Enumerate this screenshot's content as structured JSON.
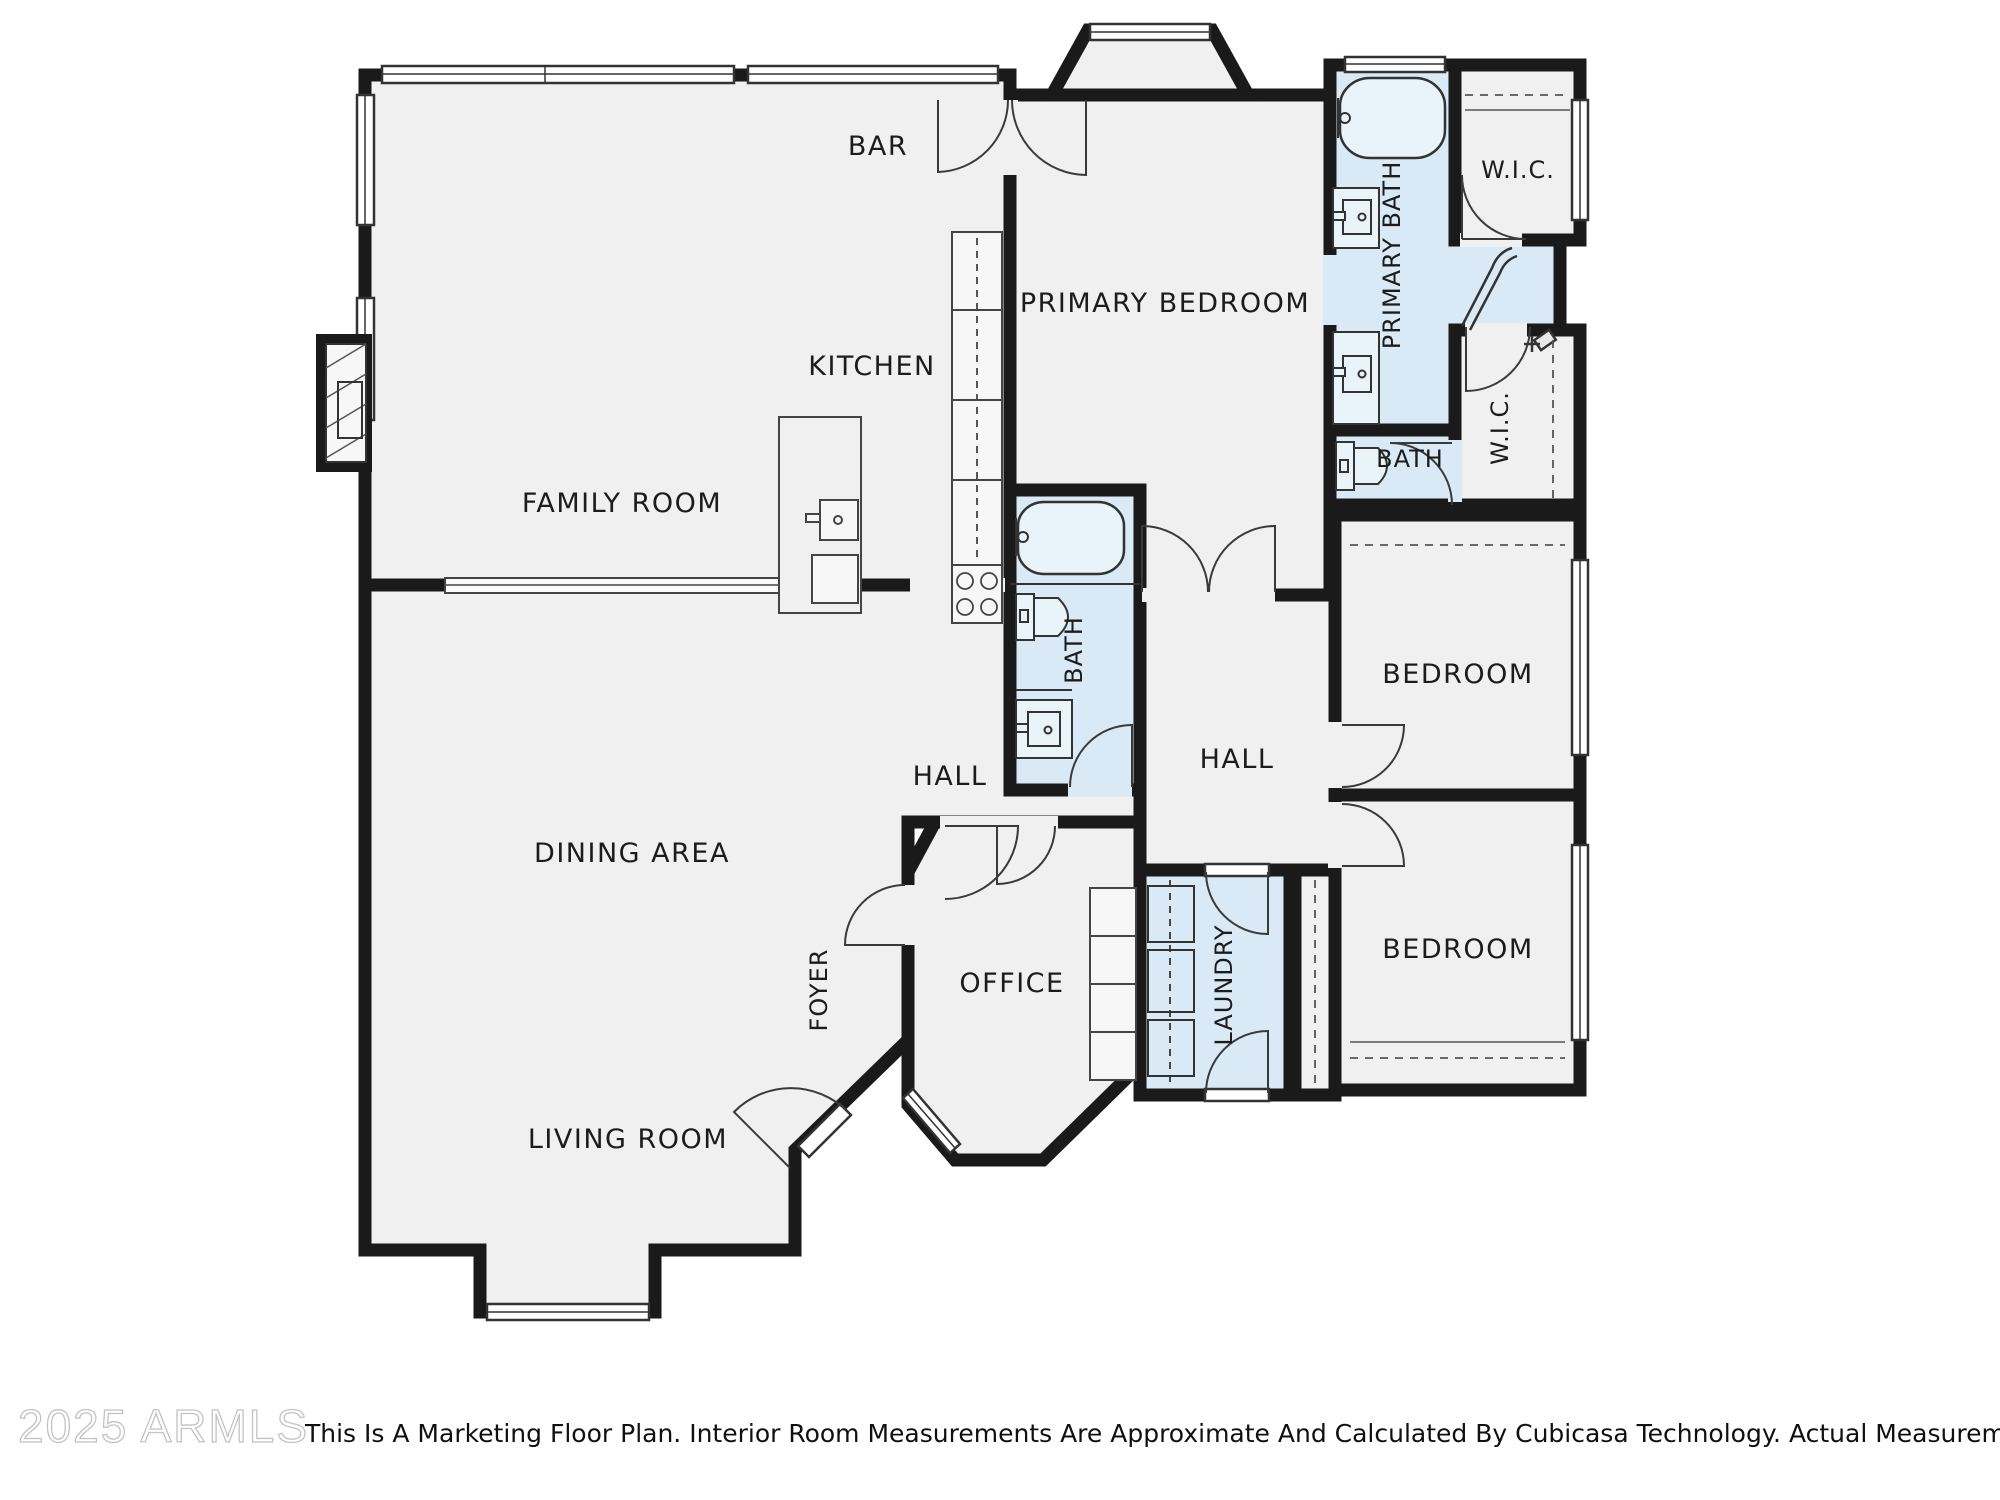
{
  "meta": {
    "watermark": "2025 ARMLS",
    "disclaimer": "This Is A Marketing Floor Plan. Interior Room Measurements Are Approximate And Calculated By Cubicasa Technology. Actual Measurements May Vary."
  },
  "colors": {
    "room_fill": "#f0f0f1",
    "wet_room_fill": "#d9eaf6",
    "wall": "#1a1a1a",
    "fixture_line": "#4a4a4a"
  },
  "rooms": {
    "bar": "BAR",
    "kitchen": "KITCHEN",
    "family_room": "FAMILY ROOM",
    "primary_bedroom": "PRIMARY BEDROOM",
    "primary_bath": "PRIMARY BATH",
    "wic_top": "W.I.C.",
    "wic_mid": "W.I.C.",
    "bath_primary_small": "BATH",
    "bath_hall": "BATH",
    "hall_right": "HALL",
    "hall_center": "HALL",
    "bedroom_right_upper": "BEDROOM",
    "bedroom_right_lower": "BEDROOM",
    "dining_area": "DINING AREA",
    "foyer": "FOYER",
    "office": "OFFICE",
    "living_room": "LIVING ROOM",
    "laundry": "LAUNDRY"
  }
}
